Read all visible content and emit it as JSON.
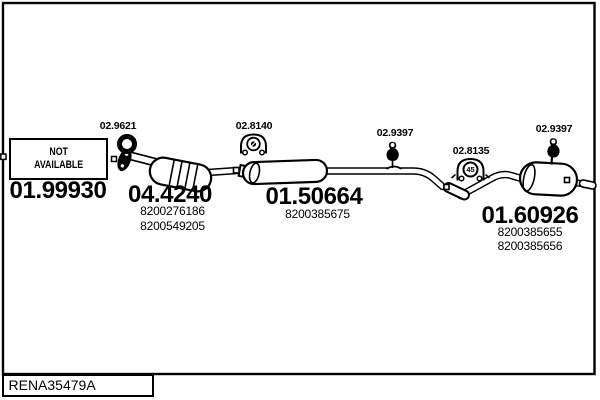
{
  "colors": {
    "ink": "#000000",
    "background": "#ffffff"
  },
  "labels": {
    "gasket": "02.9621",
    "front_section": "01.99930",
    "not_available": "NOT\nAVAILABLE",
    "catalyst": "04.4240",
    "catalyst_numbers": [
      "8200276186",
      "8200549205"
    ],
    "mid_mount": "02.8140",
    "mid_muffler": "01.50664",
    "mid_muffler_numbers": [
      "8200385675"
    ],
    "hanger_front": "02.9397",
    "clamp": "02.8135",
    "clamp_size": "45",
    "hanger_rear": "02.9397",
    "rear_muffler": "01.60926",
    "rear_muffler_numbers": [
      "8200385655",
      "8200385656"
    ]
  },
  "icons": {
    "gasket_ring": "ring-gasket-icon",
    "flange": "flange-icon",
    "rubber_mount": "rubber-mount-icon",
    "clamp": "clamp-icon",
    "hanger": "hanger-icon"
  },
  "footer": {
    "reference": "RENA35479A"
  }
}
